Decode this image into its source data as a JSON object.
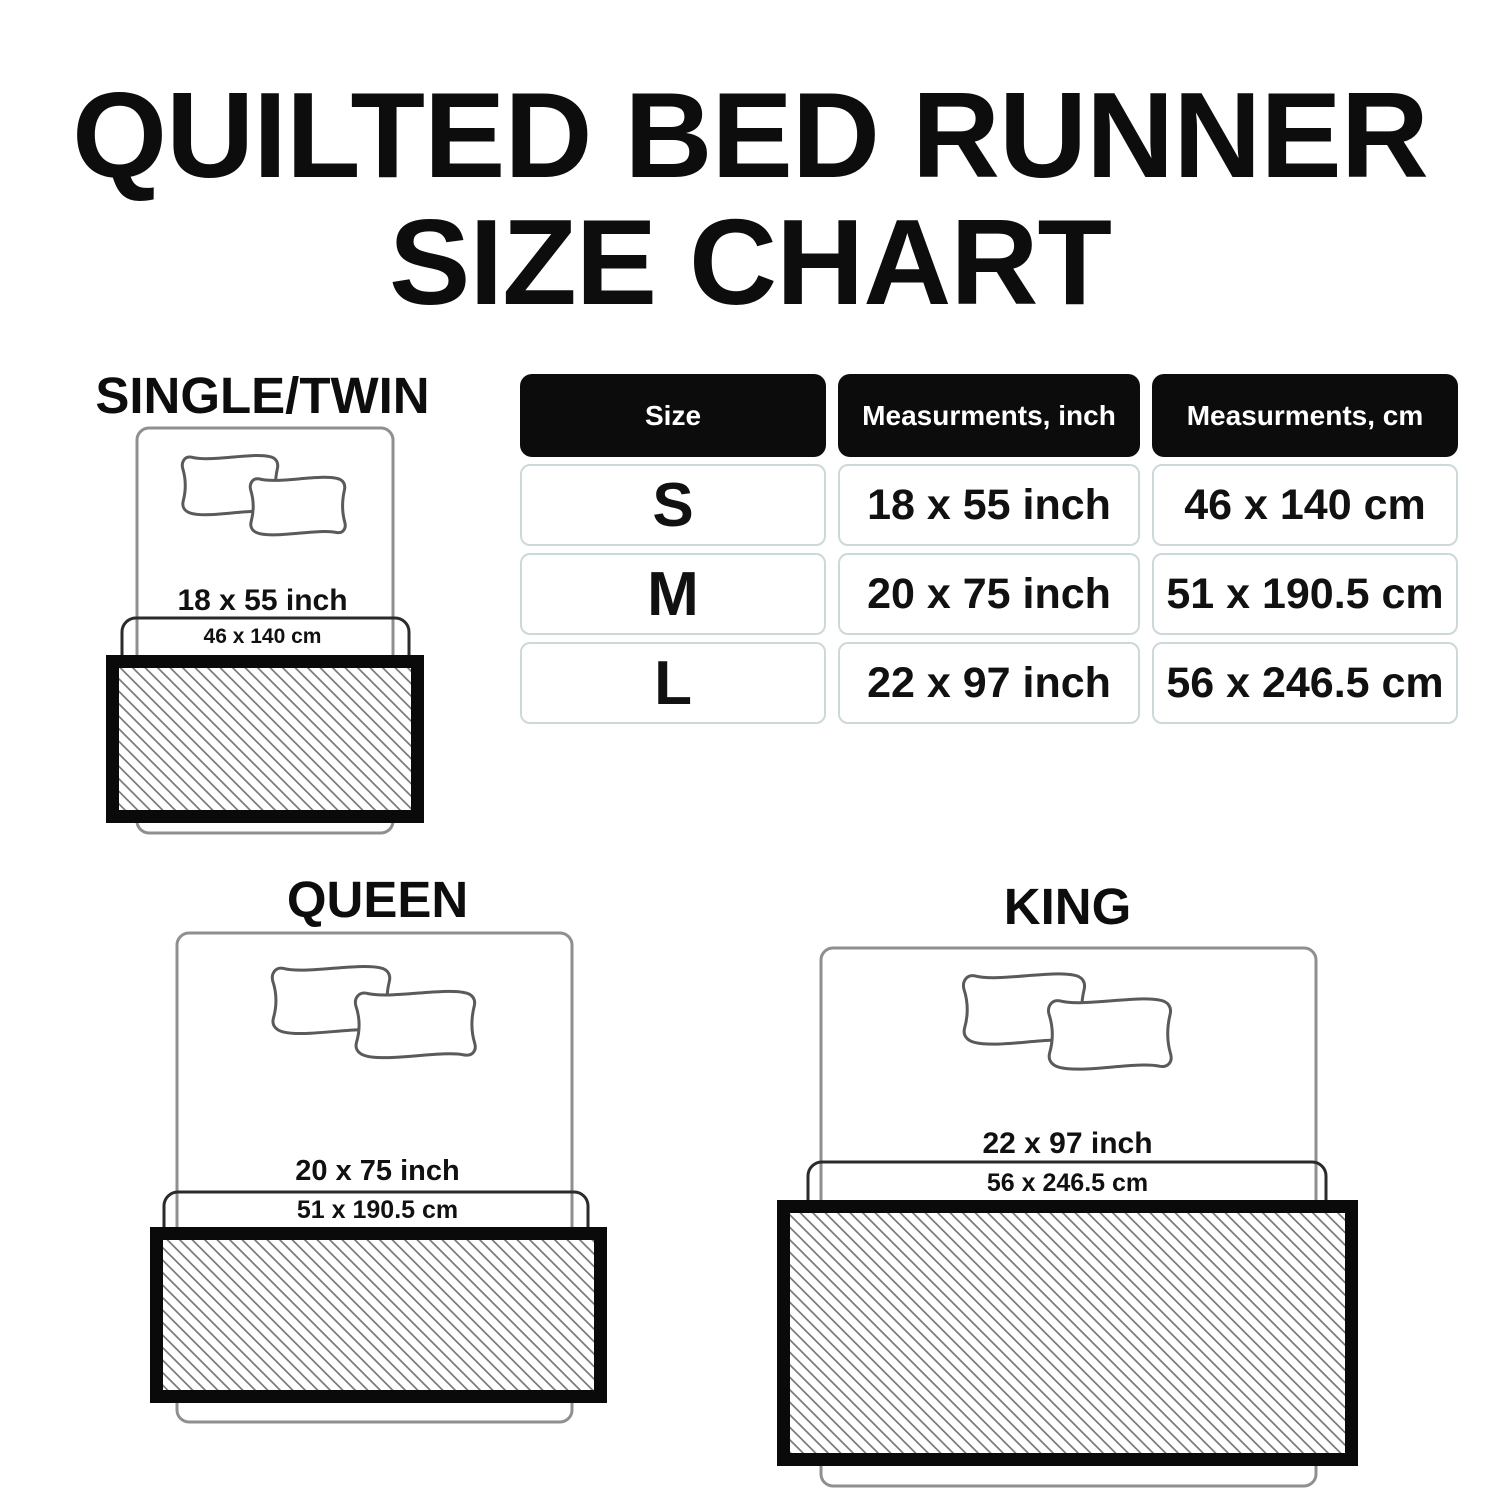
{
  "title": {
    "line1": "QUILTED BED RUNNER",
    "line2": "SIZE CHART"
  },
  "table": {
    "headers": [
      "Size",
      "Measurments, inch",
      "Measurments, cm"
    ],
    "rows": [
      {
        "size": "S",
        "inch": "18 x 55 inch",
        "cm": "46 x 140 cm"
      },
      {
        "size": "M",
        "inch": "20 x 75 inch",
        "cm": "51 x 190.5 cm"
      },
      {
        "size": "L",
        "inch": "22 x 97 inch",
        "cm": "56 x 246.5 cm"
      }
    ]
  },
  "diagrams": [
    {
      "name": "SINGLE/TWIN",
      "inch": "18 x 55 inch",
      "cm": "46 x 140 cm"
    },
    {
      "name": "QUEEN",
      "inch": "20 x 75 inch",
      "cm": "51 x 190.5 cm"
    },
    {
      "name": "KING",
      "inch": "22 x 97 inch",
      "cm": "56 x 246.5 cm"
    }
  ],
  "colors": {
    "background": "#ffffff",
    "title_text": "#0d0d0d",
    "body_text": "#111111",
    "table_header_bg": "#0c0c0c",
    "table_header_text": "#ffffff",
    "table_cell_border": "#ccd8da",
    "bed_outline": "#8f8f8f",
    "pillow_outline": "#5a5a5a",
    "runner_underlay_outline": "#2b2b2b",
    "runner_border": "#0a0a0a",
    "hatch_line": "#7b7b7b"
  }
}
